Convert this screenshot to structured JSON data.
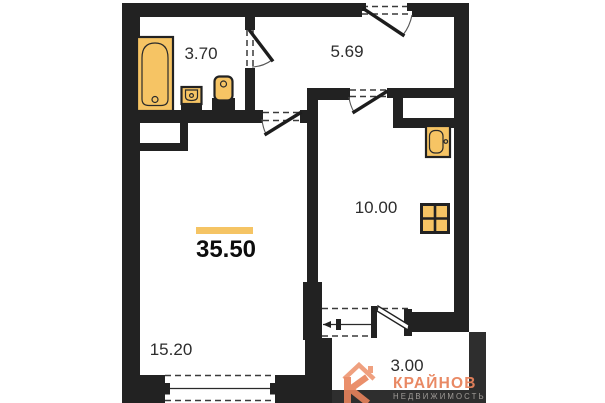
{
  "plan": {
    "type": "apartment-floor-plan",
    "total_area": "35.50",
    "rooms": [
      {
        "name": "bathroom",
        "area": "3.70"
      },
      {
        "name": "hallway",
        "area": "5.69"
      },
      {
        "name": "kitchen",
        "area": "10.00"
      },
      {
        "name": "living-room",
        "area": "15.20"
      },
      {
        "name": "balcony",
        "area": "3.00"
      }
    ],
    "fixtures": [
      "bathtub",
      "washbasin",
      "toilet",
      "kitchen-sink",
      "stove"
    ],
    "colors": {
      "wall": "#222222",
      "fixture_fill": "#F6C464",
      "accent_bar": "#F5C464",
      "brand_orange": "#E8835C",
      "subtitle_gray": "#A09C98"
    }
  },
  "watermark": {
    "brand": "КРАЙНОВ",
    "subtitle": "НЕДВИЖИМОСТЬ"
  }
}
